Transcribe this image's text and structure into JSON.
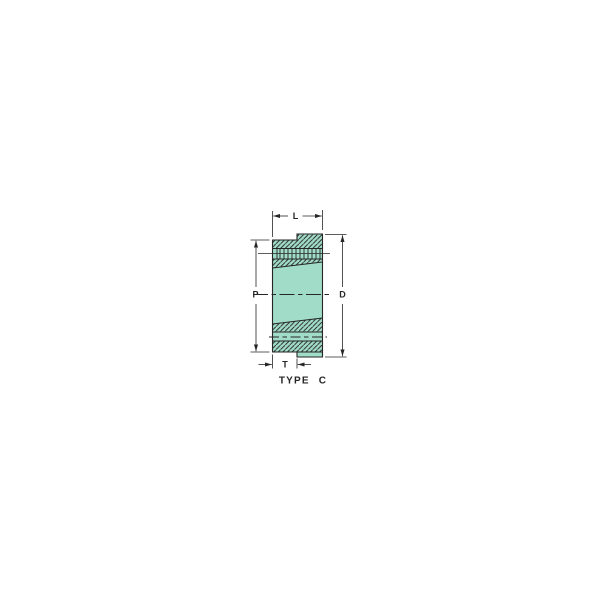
{
  "figure": {
    "caption": "TYPE C",
    "dimension_labels": {
      "top": "L",
      "left": "P",
      "right": "D",
      "bottom": "T"
    }
  },
  "colors": {
    "part_fill": "#A0DCC8",
    "line": "#262626",
    "background": "#FFFFFF"
  }
}
